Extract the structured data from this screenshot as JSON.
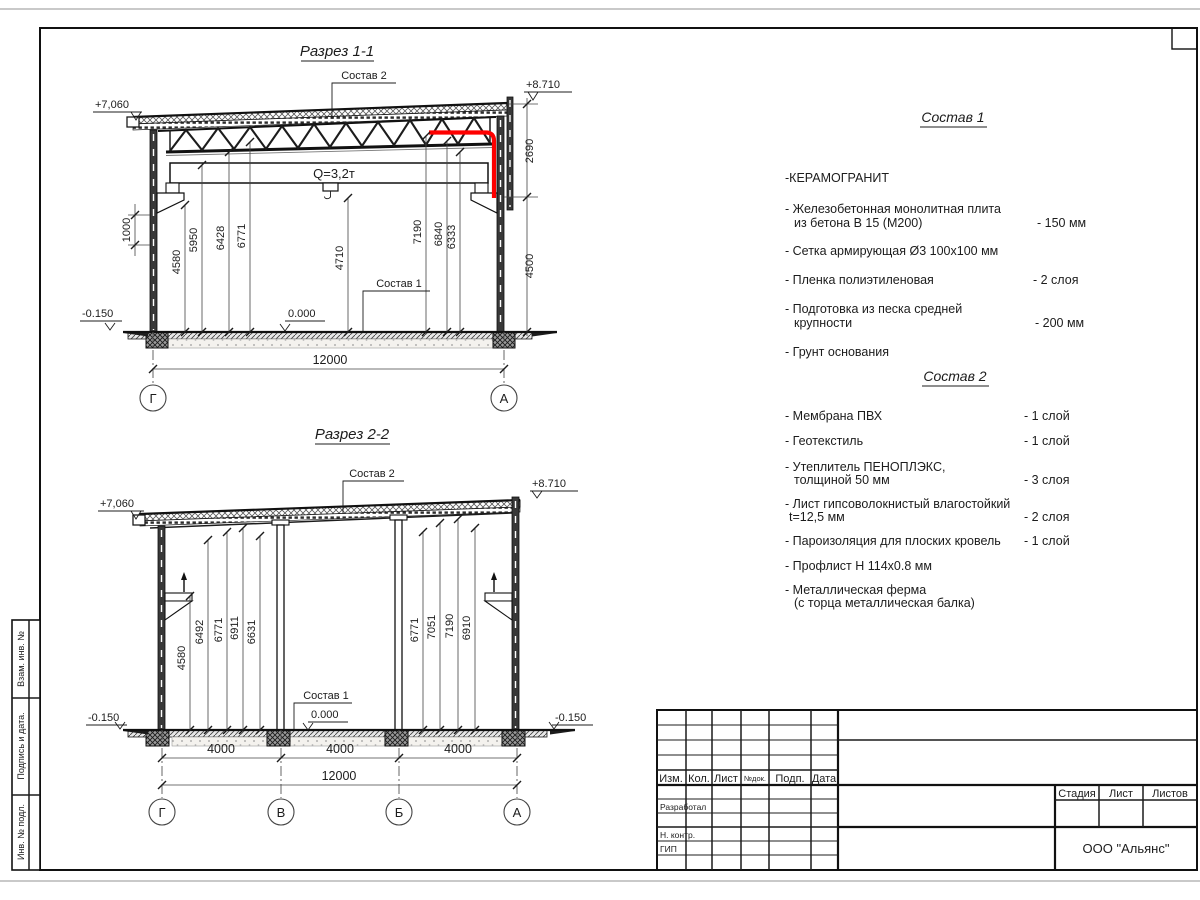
{
  "section1": {
    "title": "Разрез 1-1",
    "callout_roof": "Состав 2",
    "callout_floor": "Состав 1",
    "crane": "Q=3,2т",
    "elev_eave": "+7,060",
    "elev_parapet": "+8.710",
    "elev_ground": "-0.150",
    "elev_zero": "0.000",
    "dim_wall": "1000",
    "dim_parapet": "2690",
    "dim_rail": "4500",
    "dim_span": "12000",
    "heights": [
      "4580",
      "5950",
      "6428",
      "6771",
      "4710",
      "7190",
      "6840",
      "6333"
    ],
    "axis_left": "Г",
    "axis_right": "А"
  },
  "section2": {
    "title": "Разрез 2-2",
    "callout_roof": "Состав 2",
    "callout_floor": "Состав 1",
    "elev_eave": "+7,060",
    "elev_parapet": "+8.710",
    "elev_ground_left": "-0.150",
    "elev_ground_right": "-0.150",
    "elev_zero": "0.000",
    "heights_left": [
      "4580",
      "6492",
      "6771",
      "6911",
      "6631"
    ],
    "heights_right": [
      "6771",
      "7051",
      "7190",
      "6910"
    ],
    "bays": [
      "4000",
      "4000",
      "4000"
    ],
    "dim_span": "12000",
    "axes": [
      "Г",
      "В",
      "Б",
      "А"
    ]
  },
  "composition1": {
    "heading": "Состав 1",
    "items": [
      {
        "line1": "-КЕРАМОГРАНИТ"
      },
      {
        "line1": "- Железобетонная  монолитная плита",
        "line2": "из бетона В 15 (М200)",
        "value": "- 150 мм"
      },
      {
        "line1": "- Сетка армирующая Ø3 100х100 мм"
      },
      {
        "line1": "- Пленка полиэтиленовая",
        "value": "-  2 слоя"
      },
      {
        "line1": "- Подготовка из песка средней",
        "line2": "крупности",
        "value": "- 200 мм"
      },
      {
        "line1": "- Грунт основания"
      }
    ]
  },
  "composition2": {
    "heading": "Состав 2",
    "items": [
      {
        "line1": "- Мембрана ПВХ",
        "value": "- 1 слой"
      },
      {
        "line1": "- Геотекстиль",
        "value": "- 1 слой"
      },
      {
        "line1": "- Утеплитель ПЕНОПЛЭКС,",
        "line2": "толщиной 50 мм",
        "value": "- 3 слоя"
      },
      {
        "line1": "- Лист гипсоволокнистый влагостойкий",
        "line2": "t=12,5 мм",
        "value": "- 2 слоя"
      },
      {
        "line1": "- Пароизоляция для плоских кровель",
        "value": "- 1 слой"
      },
      {
        "line1": "- Профлист Н 114х0.8 мм"
      },
      {
        "line1": "- Металлическая ферма",
        "line2": "(с торца металлическая балка)"
      }
    ]
  },
  "titleblock": {
    "cols": [
      "Изм.",
      "Кол.",
      "Лист",
      "№док.",
      "Подп.",
      "Дата"
    ],
    "row_developed": "Разработал",
    "row_ncontrol": "Н. контр.",
    "row_gip": "ГИП",
    "stage": "Стадия",
    "sheet": "Лист",
    "sheets": "Листов",
    "company": "ООО \"Альянс\""
  },
  "sidestamp": {
    "cells": [
      "Взам. инв. №",
      "Подпись  и  дата.",
      "Инв. № подл."
    ]
  }
}
